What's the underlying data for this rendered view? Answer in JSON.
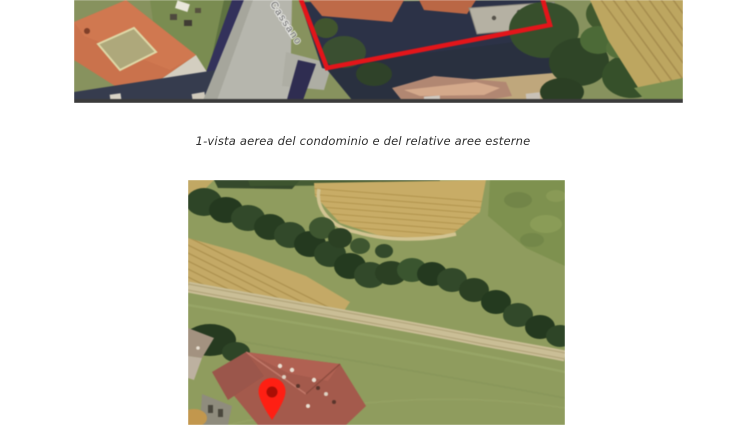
{
  "page": {
    "background": "#ffffff",
    "caption": "1-vista aerea  del condominio e del  relative aree esterne"
  },
  "top_photo": {
    "description": "aerial view of condominium parcel outlined in red beside a road",
    "street_label": "Cassano",
    "boundary_color": "#e0161b"
  },
  "bottom_photo": {
    "description": "oblique aerial view of fields, tree line, dirt track and building marked with red pin",
    "pin_color": "#fb2014",
    "pin_inner_color": "#a80f06"
  }
}
